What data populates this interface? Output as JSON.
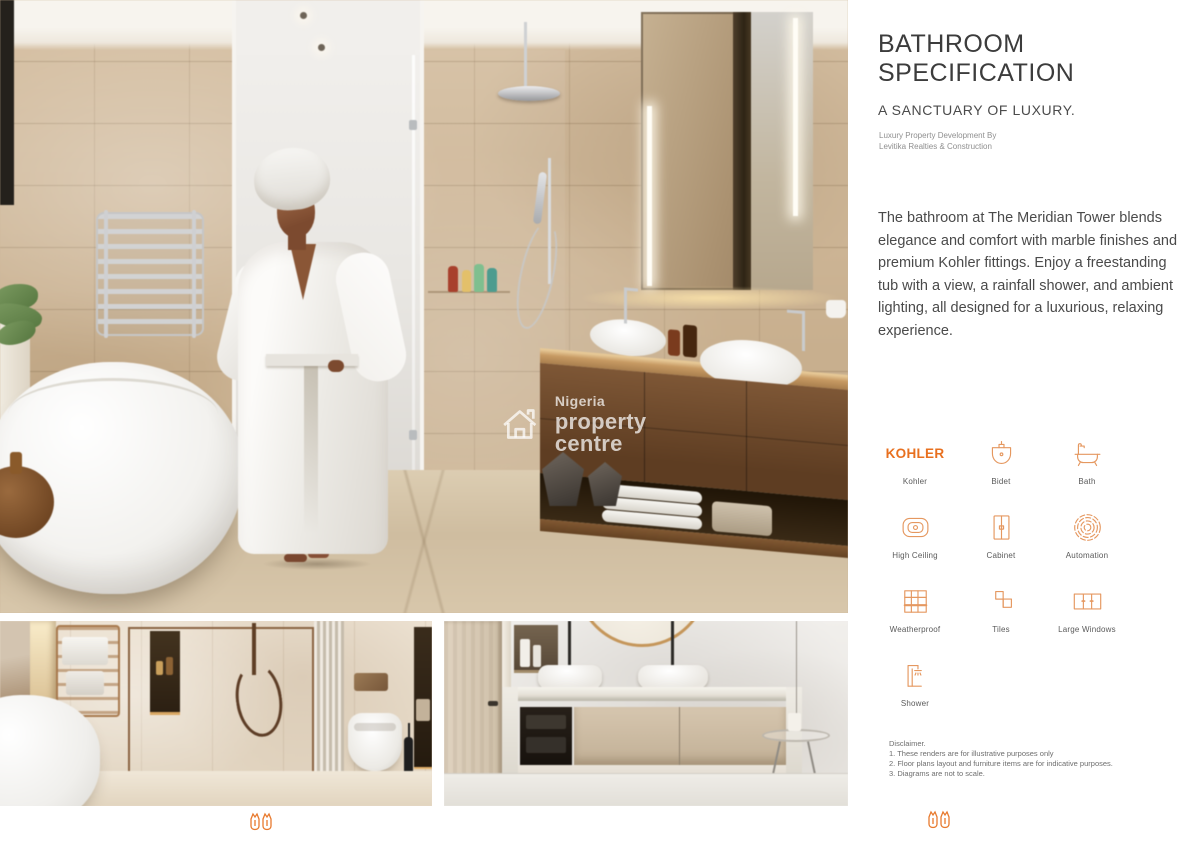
{
  "panel": {
    "title_line1": "BATHROOM",
    "title_line2": "SPECIFICATION",
    "subtitle": "A SANCTUARY OF LUXURY.",
    "byline_line1": "Luxury Property Development By",
    "byline_line2": "Levitika Realties & Construction",
    "description": "The bathroom at The Meridian Tower blends elegance and comfort with marble finishes and premium Kohler fittings. Enjoy a freestanding tub with a view, a rainfall shower, and ambient lighting, all designed for a luxurious, relaxing experience.",
    "brand_wordmark": "KOHLER",
    "features": [
      {
        "label": "Kohler",
        "icon": "kohler-wordmark"
      },
      {
        "label": "Bidet",
        "icon": "bidet"
      },
      {
        "label": "Bath",
        "icon": "bath"
      },
      {
        "label": "High Ceiling",
        "icon": "high-ceiling"
      },
      {
        "label": "Cabinet",
        "icon": "cabinet"
      },
      {
        "label": "Automation",
        "icon": "automation"
      },
      {
        "label": "Weatherproof",
        "icon": "weatherproof"
      },
      {
        "label": "Tiles",
        "icon": "tiles"
      },
      {
        "label": "Large Windows",
        "icon": "large-windows"
      },
      {
        "label": "Shower",
        "icon": "shower"
      }
    ],
    "disclaimer_heading": "Disclaimer.",
    "disclaimer_lines": [
      "1. These renders are for illustrative purposes only",
      "2. Floor plans layout and furniture items are for indicative purposes.",
      "3. Diagrams are not to scale."
    ]
  },
  "watermark": {
    "brand_top": "Nigeria",
    "brand_bottom": "property centre"
  },
  "colors": {
    "accent_orange": "#E8701F",
    "icon_orange": "#E59860",
    "title_gray": "#3C3C3C"
  }
}
